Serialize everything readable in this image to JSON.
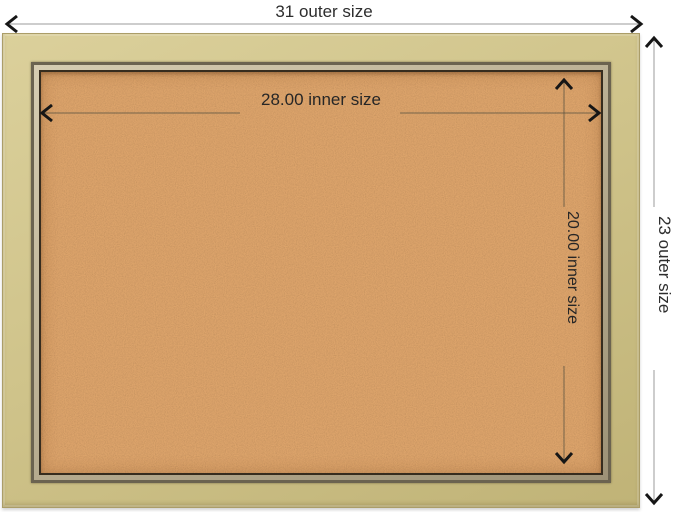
{
  "product_diagram": {
    "outer_width_label": "31 outer size",
    "outer_height_label": "23 outer size",
    "inner_width_label": "28.00 inner size",
    "inner_height_label": "20.00 inner size"
  },
  "theme": {
    "page-bg": "#ffffff",
    "frame-champagne": "#cfc38a",
    "frame-champagne-light": "#dbd09b",
    "frame-champagne-dark": "#c0b377",
    "frame-edge": "#ab9d68",
    "frame-lip": "#6b6350",
    "frame-strip": "#b6ab8f",
    "frame-strip-light": "#d6cdb2",
    "frame-inner-edge": "#362c1e",
    "cork-base": "#dda46b",
    "dim-line-outer": "#9b9b9b",
    "dim-line-inner": "#55503f",
    "arrow": "#161616",
    "text": "#2d2d2d"
  }
}
